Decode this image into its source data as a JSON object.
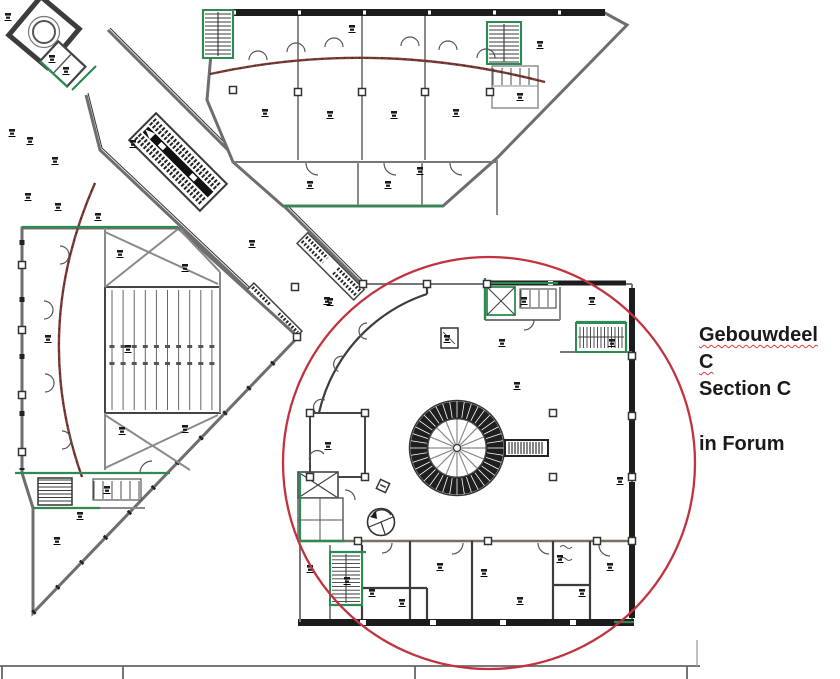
{
  "annotation": {
    "building_label_nl": "Gebouwdeel C",
    "building_label_en": "Section C",
    "location_label": "in Forum"
  },
  "highlight": {
    "shape": "circle",
    "color": "#c2323f",
    "target": "section-c"
  },
  "palette": {
    "background": "#ffffff",
    "wall_dark": "#3c3c3c",
    "wall_gray": "#6e6e6e",
    "core_green": "#2f8a52",
    "facade_dark_red": "#7e3b36",
    "highlight_red": "#c2323f",
    "text_black": "#1a1a1a"
  },
  "drawing": {
    "type": "architectural-floor-plan",
    "sections": [
      {
        "id": "stair-tower"
      },
      {
        "id": "diagonal-corridor"
      },
      {
        "id": "top-wing"
      },
      {
        "id": "left-wing"
      },
      {
        "id": "section-c"
      }
    ]
  }
}
